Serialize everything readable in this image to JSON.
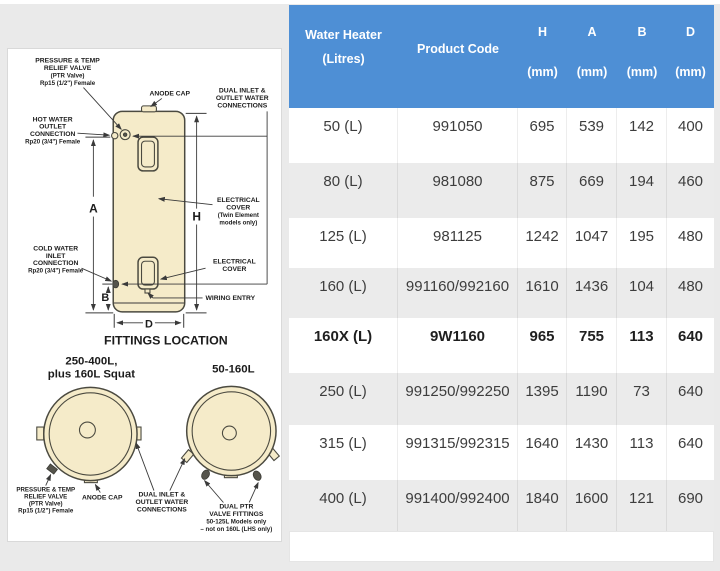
{
  "colors": {
    "header_blue": "#4e8fd5",
    "row_stripe": "#ebebeb",
    "tank_cream": "#f5ebc9",
    "title_navy": "#1d4f91"
  },
  "table": {
    "header": {
      "litres_line1": "Water Heater",
      "litres_line2": "(Litres)",
      "product_code": "Product Code",
      "dims": [
        {
          "letter": "H",
          "unit": "(mm)"
        },
        {
          "letter": "A",
          "unit": "(mm)"
        },
        {
          "letter": "B",
          "unit": "(mm)"
        },
        {
          "letter": "D",
          "unit": "(mm)"
        }
      ]
    },
    "rows": [
      {
        "litres": "50 (L)",
        "code": "991050",
        "h": "695",
        "a": "539",
        "b": "142",
        "d": "400",
        "bold": false,
        "shade": false
      },
      {
        "litres": "80 (L)",
        "code": "981080",
        "h": "875",
        "a": "669",
        "b": "194",
        "d": "460",
        "bold": false,
        "shade": true
      },
      {
        "litres": "125 (L)",
        "code": "981125",
        "h": "1242",
        "a": "1047",
        "b": "195",
        "d": "480",
        "bold": false,
        "shade": false
      },
      {
        "litres": "160 (L)",
        "code": "991160/992160",
        "h": "1610",
        "a": "1436",
        "b": "104",
        "d": "480",
        "bold": false,
        "shade": true
      },
      {
        "litres": "160X (L)",
        "code": "9W1160",
        "h": "965",
        "a": "755",
        "b": "113",
        "d": "640",
        "bold": true,
        "shade": false
      },
      {
        "litres": "250 (L)",
        "code": "991250/992250",
        "h": "1395",
        "a": "1190",
        "b": "73",
        "d": "640",
        "bold": false,
        "shade": true
      },
      {
        "litres": "315 (L)",
        "code": "991315/992315",
        "h": "1640",
        "a": "1430",
        "b": "113",
        "d": "640",
        "bold": false,
        "shade": false
      },
      {
        "litres": "400 (L)",
        "code": "991400/992400",
        "h": "1840",
        "a": "1600",
        "b": "121",
        "d": "690",
        "bold": false,
        "shade": true
      }
    ]
  },
  "diagram": {
    "ptr_label": [
      "PRESSURE & TEMP",
      "RELIEF VALVE",
      "(PTR Valve)",
      "Rp15 (1/2\") Female"
    ],
    "anode_cap": "ANODE CAP",
    "dual_top": [
      "DUAL INLET &",
      "OUTLET WATER",
      "CONNECTIONS"
    ],
    "hot_water": [
      "HOT WATER",
      "OUTLET",
      "CONNECTION",
      "Rp20 (3/4\") Female"
    ],
    "cold_water": [
      "COLD WATER",
      "INLET",
      "CONNECTION",
      "Rp20 (3/4\") Female"
    ],
    "elec_cover_twin": [
      "ELECTRICAL",
      "COVER",
      "(Twin Element",
      "models only)"
    ],
    "elec_cover": [
      "ELECTRICAL",
      "COVER"
    ],
    "wiring_entry": "WIRING ENTRY",
    "dim_a": "A",
    "dim_h": "H",
    "dim_b": "B",
    "dim_d": "D",
    "fittings_title": "FITTINGS LOCATION",
    "left_circle_label": [
      "250-400L,",
      "plus 160L Squat"
    ],
    "right_circle_label": "50-160L",
    "bottom_ptr": [
      "PRESSURE & TEMP",
      "RELIEF VALVE",
      "(PTR Valve)",
      "Rp15 (1/2\") Female"
    ],
    "bottom_anode": "ANODE CAP",
    "bottom_dual": [
      "DUAL INLET &",
      "OUTLET WATER",
      "CONNECTIONS"
    ],
    "dual_ptr": [
      "DUAL PTR",
      "VALVE FITTINGS",
      "50-125L Models only",
      "– not on 160L (LHS only)"
    ]
  }
}
